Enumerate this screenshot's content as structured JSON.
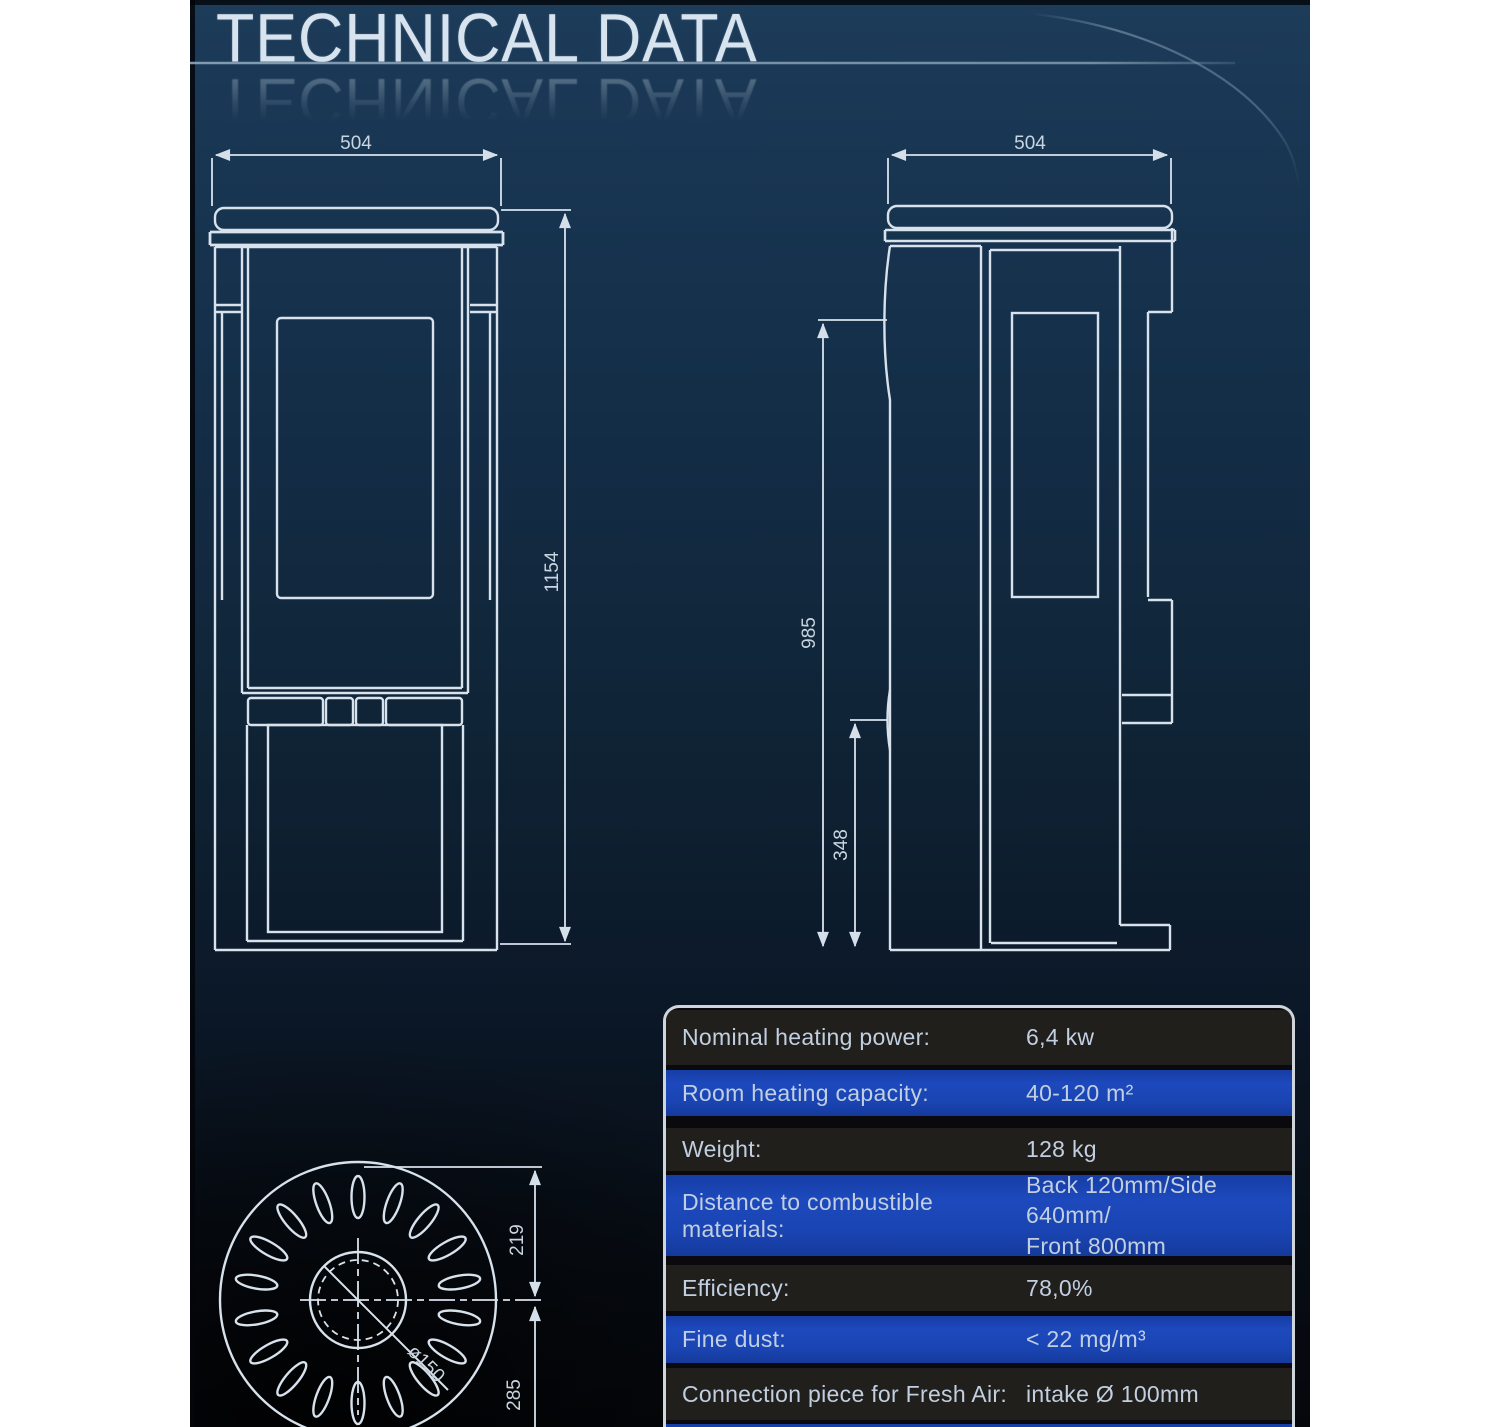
{
  "title": "TECHNICAL DATA",
  "drawings": {
    "front_view": {
      "name": "front view",
      "width_dim": "504",
      "height_dim": "1154"
    },
    "side_view": {
      "name": "side view",
      "depth_dim": "504",
      "upper_height_dim": "985",
      "lower_height_dim": "348"
    },
    "top_view": {
      "name": "top view",
      "flue_diameter_label": "ø150",
      "back_offset_dim": "219",
      "front_offset_dim": "285"
    }
  },
  "table": {
    "rows": [
      {
        "label": "Nominal heating power:",
        "value": "6,4 kw"
      },
      {
        "label": "Room heating capacity:",
        "value": "40-120 m²"
      },
      {
        "label": "Weight:",
        "value": "128 kg"
      },
      {
        "label": "Distance to combustible materials:",
        "value": "Back 120mm/Side 640mm/",
        "value2": "Front 800mm"
      },
      {
        "label": "Efficiency:",
        "value": "78,0%"
      },
      {
        "label": "Fine dust:",
        "value": "< 22 mg/m³"
      },
      {
        "label": "Connection piece for Fresh Air:",
        "value": "intake Ø 100mm"
      }
    ]
  },
  "colors": {
    "background_top": "#1d3c5a",
    "background_bottom": "#05070b",
    "line": "#d8e2ec",
    "dim_text": "#c9d5e1",
    "table_row_dark": "#201f1c",
    "table_row_blue": "#1a44b2",
    "table_border": "#cfd6db",
    "table_text": "#c2cfe0",
    "title_text": "#d7e3ee"
  }
}
